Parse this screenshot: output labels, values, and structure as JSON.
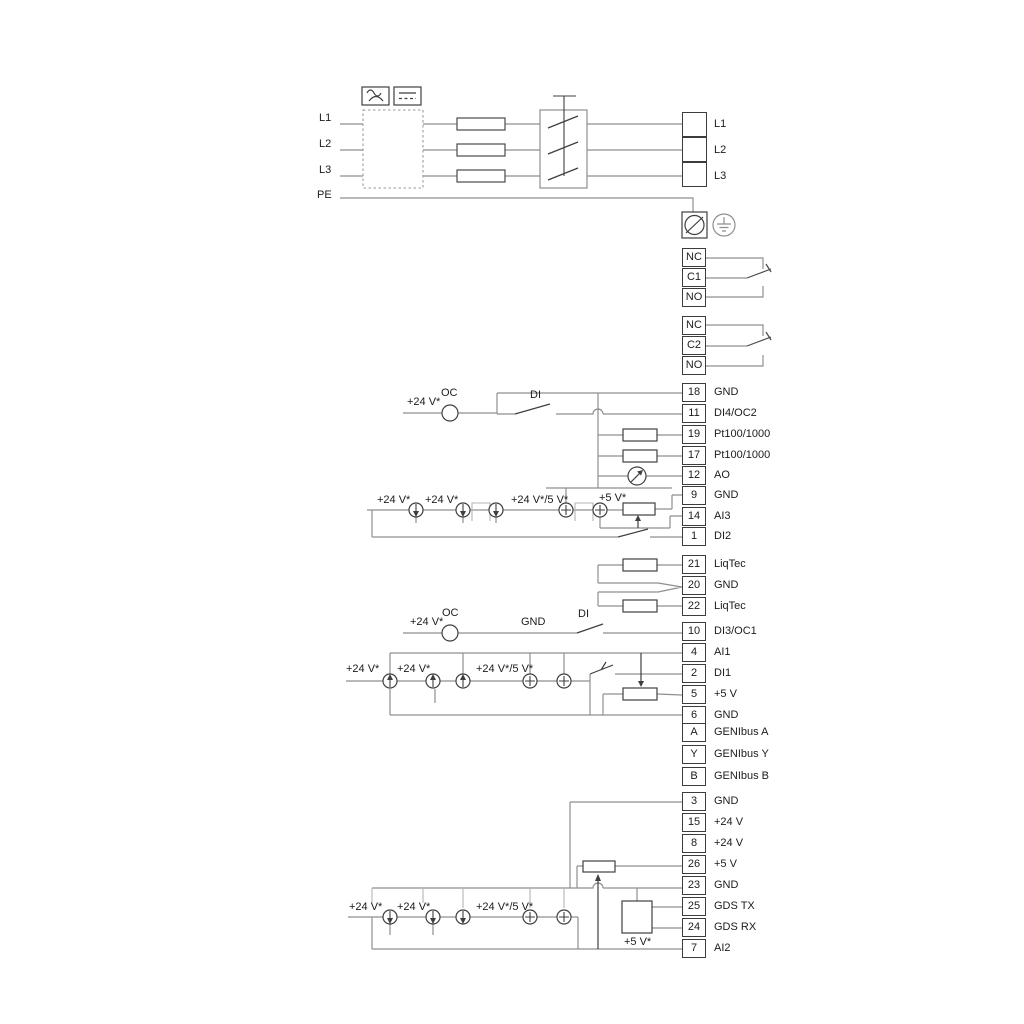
{
  "diagram_type": "pump-drive wiring diagram",
  "colors": {
    "wire": "#8f8f8f",
    "component": "#3f3f3f",
    "text": "#1c1c1c",
    "frame": "#b5b5b5"
  },
  "mains": {
    "left_labels": {
      "l1": "L1",
      "l2": "L2",
      "l3": "L3",
      "pe": "PE"
    },
    "right_labels": {
      "l1": "L1",
      "l2": "L2",
      "l3": "L3"
    }
  },
  "relays": {
    "relay1": [
      {
        "label": "NC"
      },
      {
        "label": "C1"
      },
      {
        "label": "NO"
      }
    ],
    "relay2": [
      {
        "label": "NC"
      },
      {
        "label": "C2"
      },
      {
        "label": "NO"
      }
    ]
  },
  "terminals": {
    "io1": [
      {
        "num": "18",
        "label": "GND"
      },
      {
        "num": "11",
        "label": "DI4/OC2"
      },
      {
        "num": "19",
        "label": "Pt100/1000"
      },
      {
        "num": "17",
        "label": "Pt100/1000"
      },
      {
        "num": "12",
        "label": "AO"
      },
      {
        "num": "9",
        "label": "GND"
      },
      {
        "num": "14",
        "label": "AI3"
      },
      {
        "num": "1",
        "label": "DI2"
      }
    ],
    "liqtec": [
      {
        "num": "21",
        "label": "LiqTec"
      },
      {
        "num": "20",
        "label": "GND"
      },
      {
        "num": "22",
        "label": "LiqTec"
      }
    ],
    "di3": [
      {
        "num": "10",
        "label": "DI3/OC1"
      }
    ],
    "ai1": [
      {
        "num": "4",
        "label": "AI1"
      },
      {
        "num": "2",
        "label": "DI1"
      },
      {
        "num": "5",
        "label": "+5 V"
      },
      {
        "num": "6",
        "label": "GND"
      }
    ],
    "genibus": [
      {
        "num": "A",
        "label": "GENIbus A"
      },
      {
        "num": "Y",
        "label": "GENIbus Y"
      },
      {
        "num": "B",
        "label": "GENIbus B"
      }
    ],
    "bottom": [
      {
        "num": "3",
        "label": "GND"
      },
      {
        "num": "15",
        "label": "+24 V"
      },
      {
        "num": "8",
        "label": "+24 V"
      },
      {
        "num": "26",
        "label": "+5 V"
      },
      {
        "num": "23",
        "label": "GND"
      },
      {
        "num": "25",
        "label": "GDS TX"
      },
      {
        "num": "24",
        "label": "GDS RX"
      },
      {
        "num": "7",
        "label": "AI2"
      }
    ]
  },
  "annotations": {
    "a_24v": "+24 V*",
    "a_oc": "OC",
    "a_di": "DI",
    "b_24v_1": "+24 V*",
    "b_24v_2": "+24 V*",
    "b_24v5v": "+24 V*/5 V*",
    "b_5v": "+5 V*",
    "d_24v": "+24 V*",
    "d_oc": "OC",
    "d_gnd": "GND",
    "d_di": "DI",
    "e_24v_1": "+24 V*",
    "e_24v_2": "+24 V*",
    "e_24v5v": "+24 V*/5 V*",
    "g_24v_1": "+24 V*",
    "g_24v_2": "+24 V*",
    "g_24v5v": "+24 V*/5 V*",
    "g_5v": "+5 V*"
  },
  "icons": {
    "ac_symbol": "ac-wave-icon",
    "dc_symbol": "dc-lines-icon",
    "fuse": "fuse-icon",
    "contactor": "contactor-icon",
    "screw_terminal": "screw-terminal-icon",
    "earth": "earth-ground-icon",
    "current_source": "current-source-icon",
    "potentiometer": "potentiometer-icon",
    "meter": "analog-output-meter-icon",
    "resistor": "resistor-icon",
    "switch": "switch-contact-icon",
    "gds_module": "gds-module-icon"
  }
}
